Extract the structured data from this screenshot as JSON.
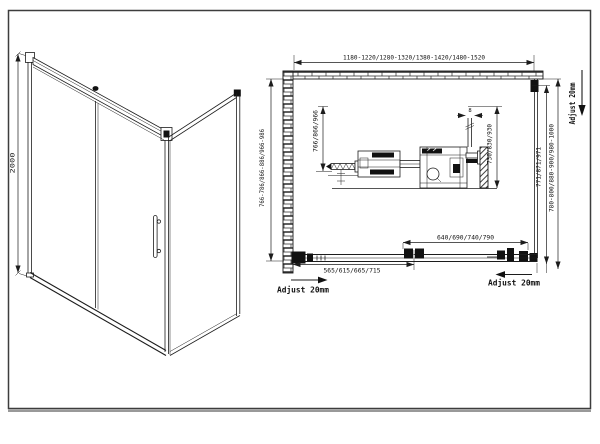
{
  "colors": {
    "line": "#1c1c1c",
    "hardware_fill": "#111111",
    "background": "#ffffff"
  },
  "perspective_view": {
    "height_label": "2000"
  },
  "plan_view": {
    "width_options": "1180-1220/1280-1320/1380-1420/1480-1520",
    "depth_left_outer": "766-786/866-886/966-986",
    "depth_left_inner": "766/866/966",
    "glass_thickness": "8",
    "detail_depth": "730/830/930",
    "depth_right_inner": "771/871/971",
    "depth_right_outer": "780-800/880-900/980-1000",
    "door_width_upper": "640/690/740/790",
    "door_width_lower": "565/615/665/715",
    "adjust_top_right": "Adjust 20mm",
    "adjust_bottom_left": "Adjust 20mm",
    "adjust_bottom_right": "Adjust 20mm"
  }
}
